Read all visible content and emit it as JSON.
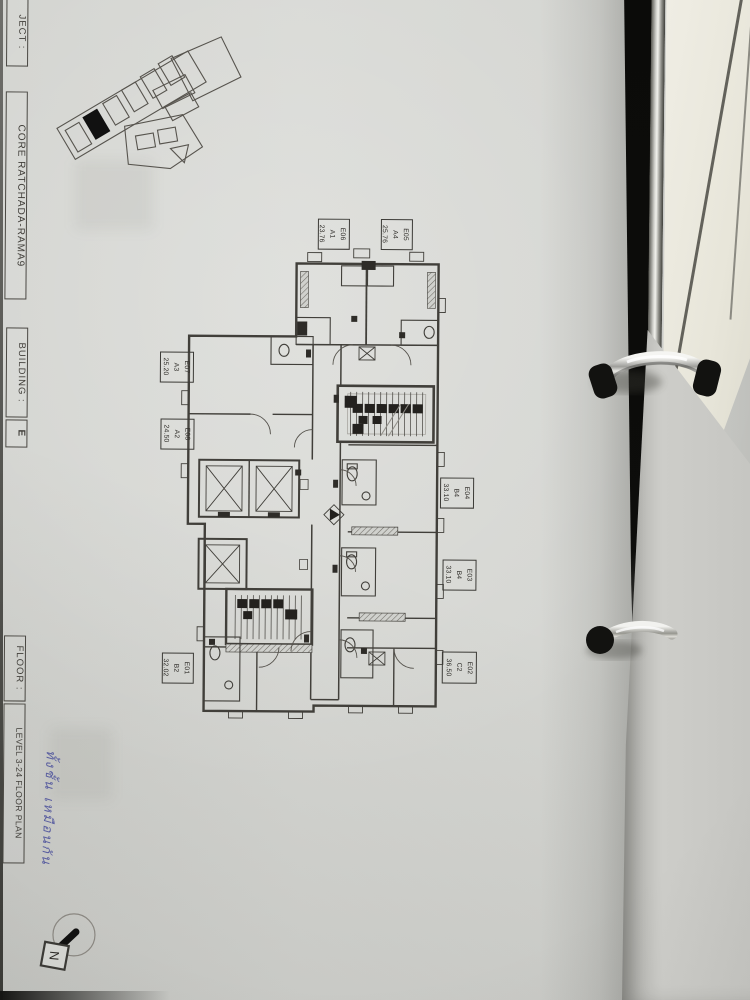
{
  "sheet": {
    "project_label_partial": "JECT :",
    "project_name": "CORE RATCHADA-RAMA9",
    "building_label": "BUILDING :",
    "building_value": "E",
    "floor_label": "FLOOR :",
    "floor_value": "LEVEL 3-24 FLOOR PLAN"
  },
  "plan": {
    "units": [
      {
        "id": "E01",
        "type": "B2",
        "area": "32.02"
      },
      {
        "id": "E02",
        "type": "C2",
        "area": "36.50"
      },
      {
        "id": "E03",
        "type": "B4",
        "area": "33.10"
      },
      {
        "id": "E04",
        "type": "B4",
        "area": "33.10"
      },
      {
        "id": "E05",
        "type": "A4",
        "area": "25.76"
      },
      {
        "id": "E06",
        "type": "A1",
        "area": "23.76"
      },
      {
        "id": "E07",
        "type": "A3",
        "area": "25.20"
      },
      {
        "id": "E08",
        "type": "A2",
        "area": "24.50"
      }
    ],
    "compass_label": "N"
  },
  "annotations": {
    "handwritten_note": "ทั้งชั้น เหมือนกัน"
  },
  "colors": {
    "paper": "#d5d6d2",
    "ink": "#3b3a36",
    "handwriting_ink": "#4a4f9b",
    "binder_dark": "#0b0b09",
    "pages_cream": "#eae8dd",
    "ring_chrome": "#cfcfca"
  }
}
